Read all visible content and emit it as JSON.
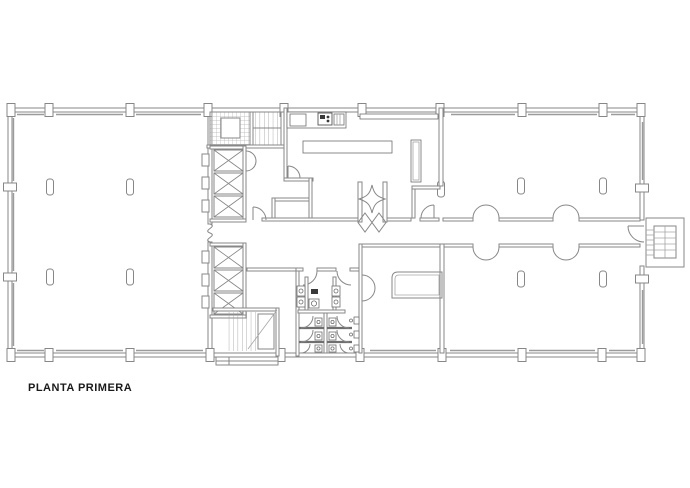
{
  "drawing": {
    "title_label": "PLANTA PRIMERA"
  },
  "colors": {
    "background": "#ffffff",
    "wall_line": "#878787",
    "window_line": "#9b9b9b",
    "hatch_line": "#b2b2b2",
    "fixture_dark": "#3a3a3a",
    "label_text": "#1a1a1a"
  }
}
